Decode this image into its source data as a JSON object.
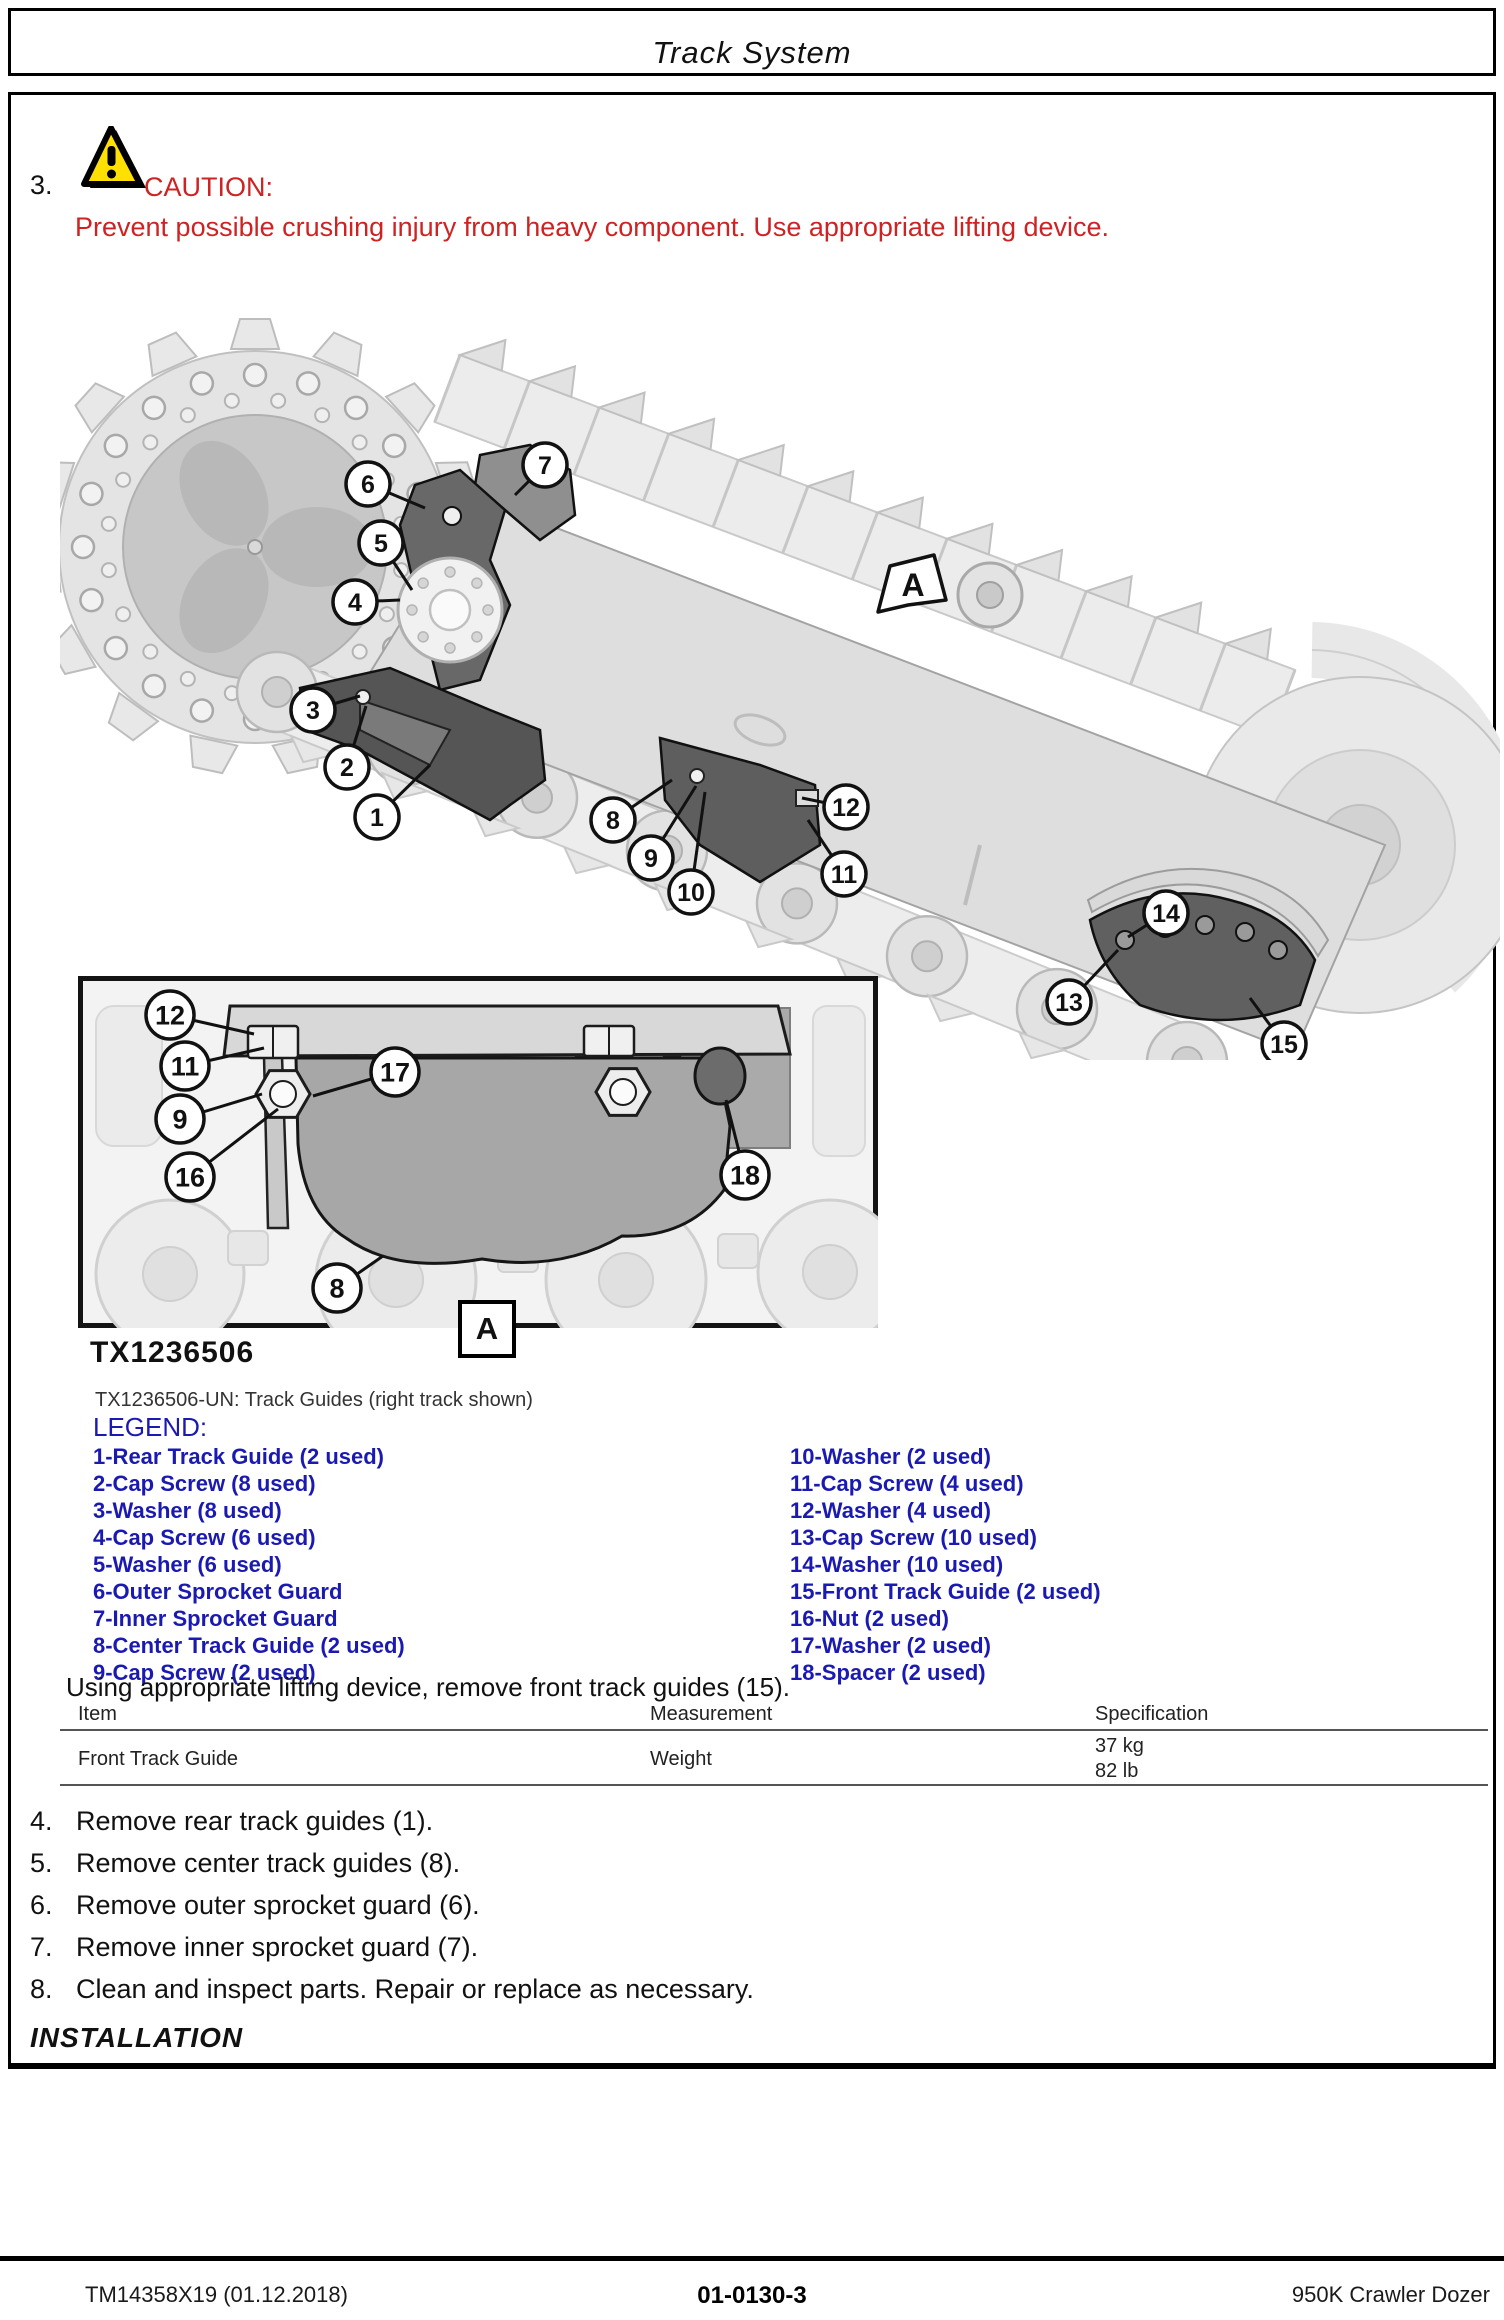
{
  "page_header": {
    "title": "Track System"
  },
  "caution": {
    "step_number": "3.",
    "label": "CAUTION:",
    "text": "Prevent possible crushing injury from heavy component. Use appropriate lifting device."
  },
  "colors": {
    "caution_red": "#cf2222",
    "legend_blue": "#1a1ab3",
    "warning_yellow": "#ffe000"
  },
  "figure": {
    "id_label": "TX1236506",
    "caption": "TX1236506-UN: Track Guides (right track shown)",
    "view_letter": "A",
    "main_callouts": [
      {
        "n": "6",
        "cx": 308,
        "cy": 224,
        "tx": 365,
        "ty": 248
      },
      {
        "n": "7",
        "cx": 485,
        "cy": 205,
        "tx": 455,
        "ty": 235
      },
      {
        "n": "5",
        "cx": 321,
        "cy": 283,
        "tx": 352,
        "ty": 330
      },
      {
        "n": "4",
        "cx": 295,
        "cy": 342,
        "tx": 340,
        "ty": 340
      },
      {
        "n": "3",
        "cx": 253,
        "cy": 450,
        "tx": 300,
        "ty": 436
      },
      {
        "n": "2",
        "cx": 287,
        "cy": 507,
        "tx": 306,
        "ty": 446
      },
      {
        "n": "1",
        "cx": 317,
        "cy": 557,
        "tx": 370,
        "ty": 505
      },
      {
        "n": "8",
        "cx": 553,
        "cy": 560,
        "tx": 612,
        "ty": 520
      },
      {
        "n": "9",
        "cx": 591,
        "cy": 598,
        "tx": 636,
        "ty": 526
      },
      {
        "n": "10",
        "cx": 631,
        "cy": 632,
        "tx": 645,
        "ty": 532
      },
      {
        "n": "12",
        "cx": 786,
        "cy": 547,
        "tx": 742,
        "ty": 538
      },
      {
        "n": "11",
        "cx": 784,
        "cy": 614,
        "tx": 748,
        "ty": 560
      },
      {
        "n": "14",
        "cx": 1106,
        "cy": 653,
        "tx": 1068,
        "ty": 677
      },
      {
        "n": "13",
        "cx": 1009,
        "cy": 742,
        "tx": 1058,
        "ty": 690
      },
      {
        "n": "15",
        "cx": 1224,
        "cy": 784,
        "tx": 1190,
        "ty": 738
      }
    ],
    "inset_callouts": [
      {
        "n": "12",
        "cx": 92,
        "cy": 39,
        "tx": 176,
        "ty": 58
      },
      {
        "n": "11",
        "cx": 107,
        "cy": 90,
        "tx": 186,
        "ty": 72
      },
      {
        "n": "17",
        "cx": 317,
        "cy": 96,
        "tx": 235,
        "ty": 120
      },
      {
        "n": "9",
        "cx": 102,
        "cy": 143,
        "tx": 184,
        "ty": 118
      },
      {
        "n": "16",
        "cx": 112,
        "cy": 201,
        "tx": 200,
        "ty": 133
      },
      {
        "n": "18",
        "cx": 667,
        "cy": 199,
        "tx": 648,
        "ty": 124
      },
      {
        "n": "8",
        "cx": 259,
        "cy": 312,
        "tx": 305,
        "ty": 280
      }
    ]
  },
  "legend": {
    "heading": "LEGEND:",
    "left": [
      "1-Rear Track Guide (2 used)",
      "2-Cap Screw (8 used)",
      "3-Washer (8 used)",
      "4-Cap Screw (6 used)",
      "5-Washer (6 used)",
      "6-Outer Sprocket Guard",
      "7-Inner Sprocket Guard",
      "8-Center Track Guide (2 used)",
      "9-Cap Screw (2 used)"
    ],
    "right": [
      "10-Washer (2 used)",
      "11-Cap Screw (4 used)",
      "12-Washer (4 used)",
      "13-Cap Screw (10 used)",
      "14-Washer (10 used)",
      "15-Front Track Guide (2 used)",
      "16-Nut (2 used)",
      "17-Washer (2 used)",
      "18-Spacer (2 used)"
    ]
  },
  "instruction": "Using appropriate lifting device, remove front track guides (15).",
  "spec_table": {
    "headers": [
      "Item",
      "Measurement",
      "Specification"
    ],
    "row": {
      "item": "Front Track Guide",
      "measurement": "Weight",
      "spec_lines": [
        "37 kg",
        "82 lb"
      ]
    }
  },
  "steps": [
    {
      "num": "4.",
      "text": "Remove rear track guides (1)."
    },
    {
      "num": "5.",
      "text": "Remove center track guides (8)."
    },
    {
      "num": "6.",
      "text": "Remove outer sprocket guard (6)."
    },
    {
      "num": "7.",
      "text": "Remove inner sprocket guard (7)."
    },
    {
      "num": "8.",
      "text": "Clean and inspect parts. Repair or replace as necessary."
    }
  ],
  "installation_heading": "INSTALLATION",
  "page_footer": {
    "left": "TM14358X19 (01.12.2018)",
    "center": "01-0130-3",
    "right": "950K Crawler Dozer"
  }
}
